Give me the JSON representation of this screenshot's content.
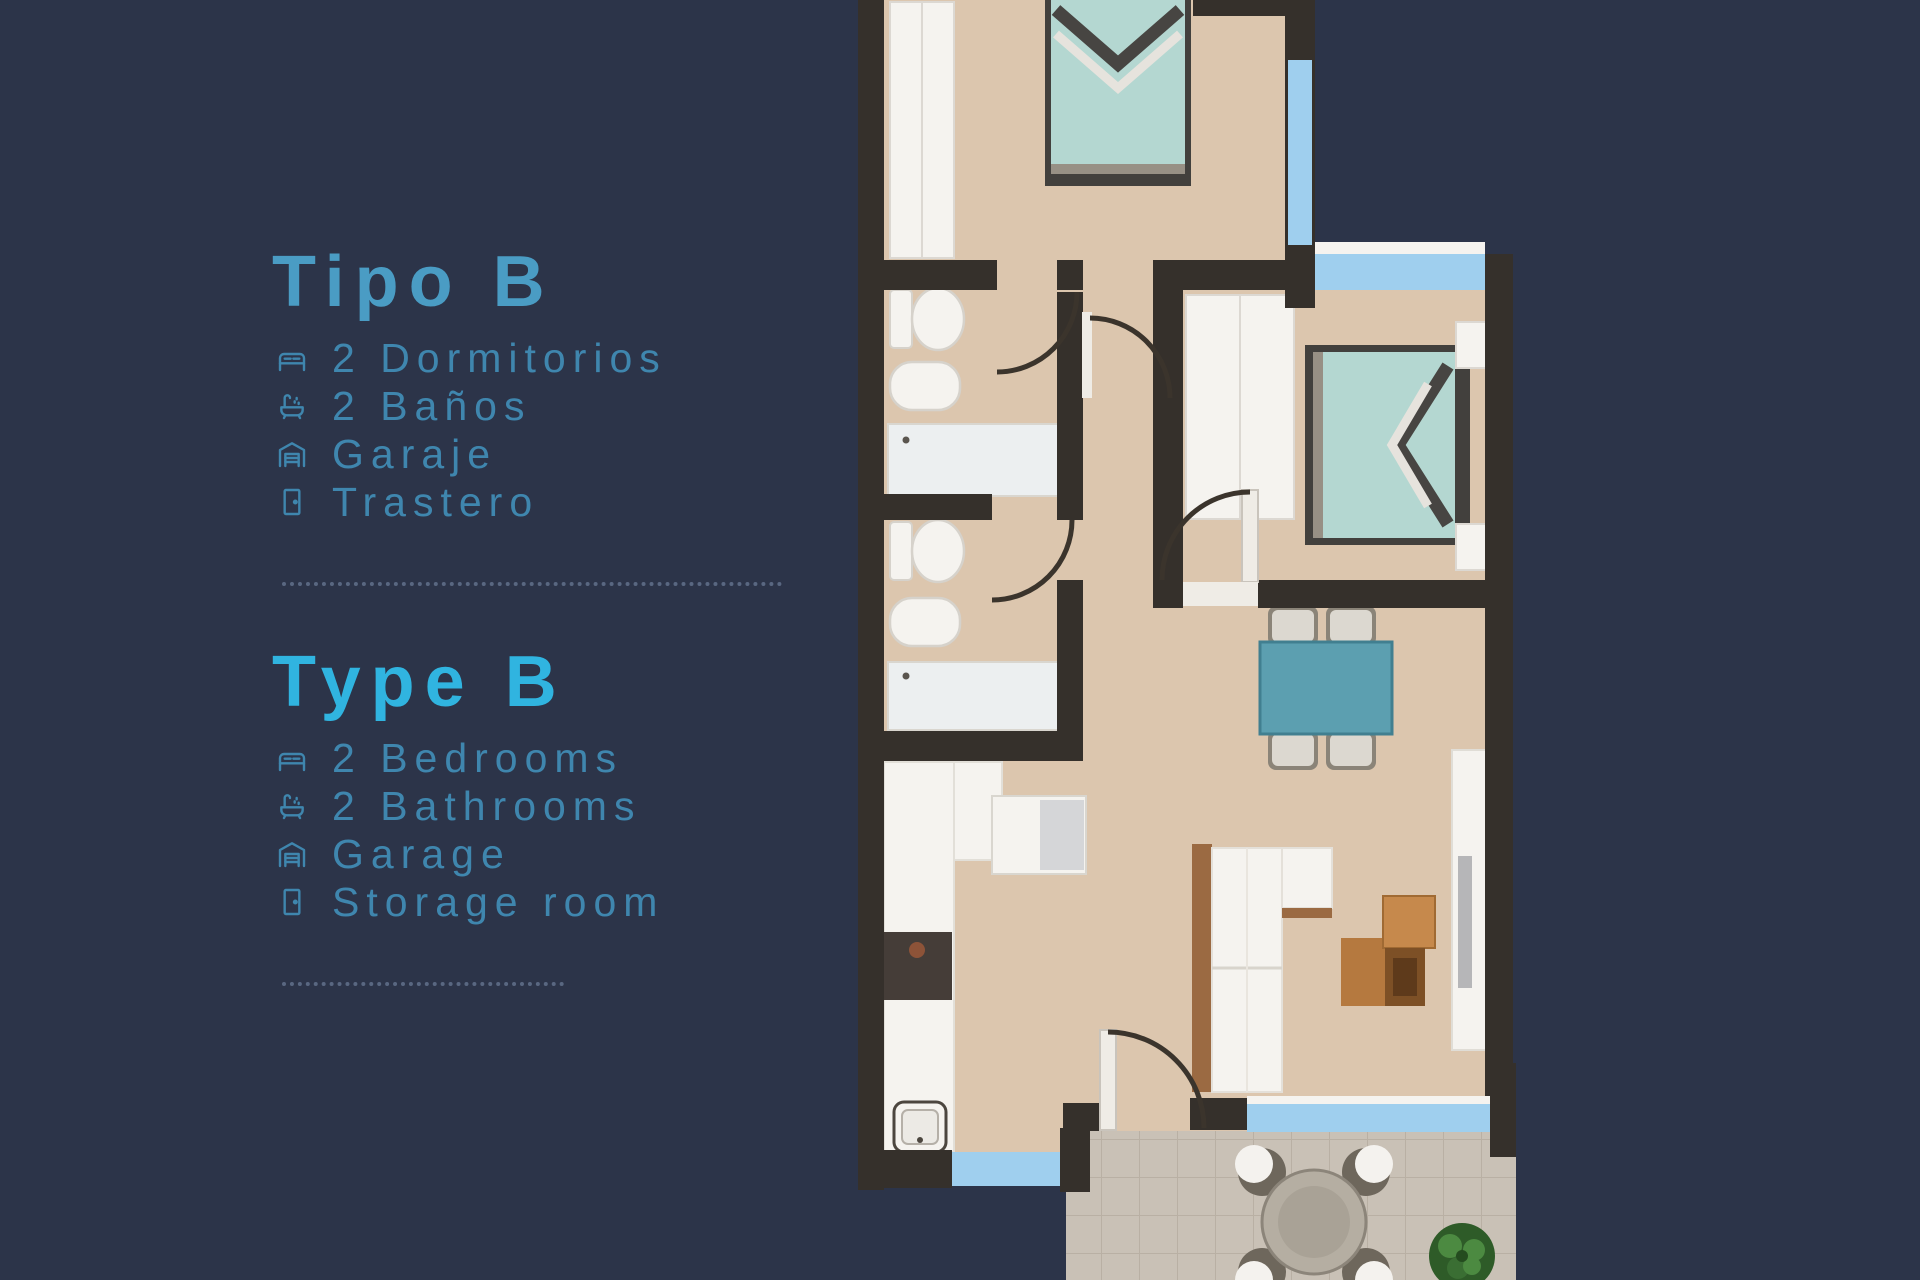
{
  "legend": {
    "sections": [
      {
        "heading": "Tipo B",
        "items": [
          {
            "icon": "bed-icon",
            "icon_ref": "#icon-bed",
            "label": "2 Dormitorios"
          },
          {
            "icon": "bath-icon",
            "icon_ref": "#icon-bath",
            "label": "2 Baños"
          },
          {
            "icon": "garage-icon",
            "icon_ref": "#icon-garage",
            "label": "Garaje"
          },
          {
            "icon": "door-icon",
            "icon_ref": "#icon-door",
            "label": "Trastero"
          }
        ]
      },
      {
        "heading": "Type B",
        "items": [
          {
            "icon": "bed-icon",
            "icon_ref": "#icon-bed",
            "label": "2 Bedrooms"
          },
          {
            "icon": "bath-icon",
            "icon_ref": "#icon-bath",
            "label": "2 Bathrooms"
          },
          {
            "icon": "garage-icon",
            "icon_ref": "#icon-garage",
            "label": "Garage"
          },
          {
            "icon": "door-icon",
            "icon_ref": "#icon-door",
            "label": "Storage room"
          }
        ]
      }
    ]
  },
  "theme": {
    "bg": "#2c3449",
    "heading-es": "#4a9cc4",
    "heading-en": "#30b4e0",
    "item": "#3f86ae",
    "divider": "#5c6a84",
    "wall": "#35302b",
    "floor": "#dcc6ae",
    "window": "#9fcfee",
    "white": "#f5f3ef",
    "bed": "#b4d7d1",
    "bed-frame": "#42403d",
    "table": "#5c9fb0",
    "tile": "#c9c1b6",
    "tile-line": "#b9b0a4",
    "wood": "#9b6a42",
    "steel": "#d5d6d8",
    "plant": "#4c8a41",
    "fix": "#d6d2cb"
  }
}
